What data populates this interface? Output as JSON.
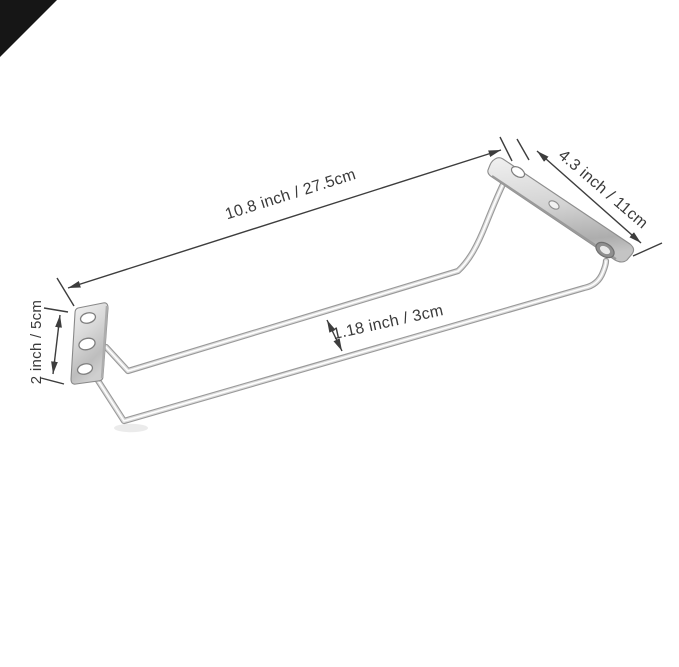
{
  "scene": {
    "type": "product-dimension-photo",
    "background_color": "#ffffff",
    "corner_fold_color": "#161616",
    "dimension_line_color": "#3d3d3d",
    "label_text_color": "#3a3a3a",
    "metal_highlight_color": "#f2f2f2",
    "metal_mid_color": "#c6c6c6",
    "metal_edge_color": "#8f8f8f"
  },
  "annotations": {
    "overall_length": "10.8 inch / 27.5cm",
    "bracket_length": "4.3 inch / 11cm",
    "bracket_height": "2 inch / 5cm",
    "rail_gap": "1.18 inch / 3cm"
  }
}
